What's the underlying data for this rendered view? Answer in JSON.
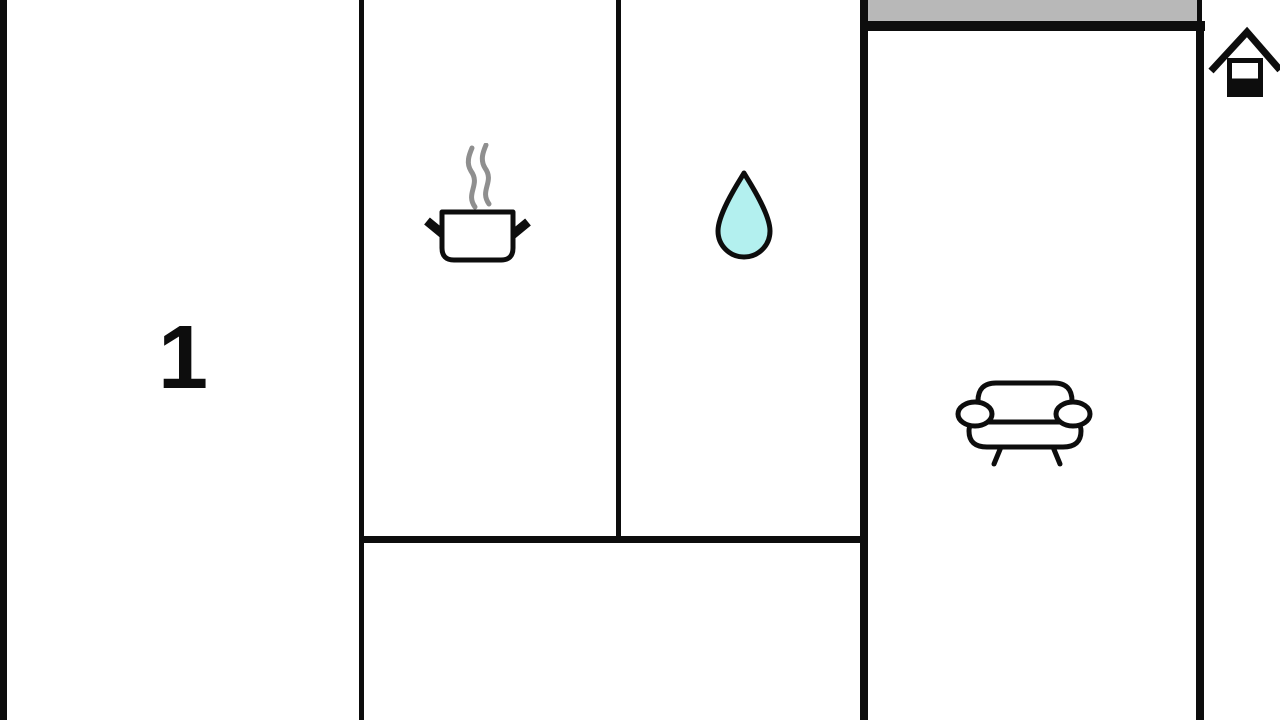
{
  "floorplan": {
    "room_label": "1",
    "icons": [
      {
        "name": "cooking-pot-icon",
        "room": "kitchen"
      },
      {
        "name": "water-drop-icon",
        "room": "bathroom"
      },
      {
        "name": "sofa-icon",
        "room": "living-room"
      },
      {
        "name": "house-logo",
        "room": "none"
      }
    ],
    "colors": {
      "wall": "#0d0d0d",
      "background": "#ffffff",
      "terrace": "#b8b8b8",
      "water": "#b3f0ef",
      "steam": "#8f8f8f"
    }
  }
}
